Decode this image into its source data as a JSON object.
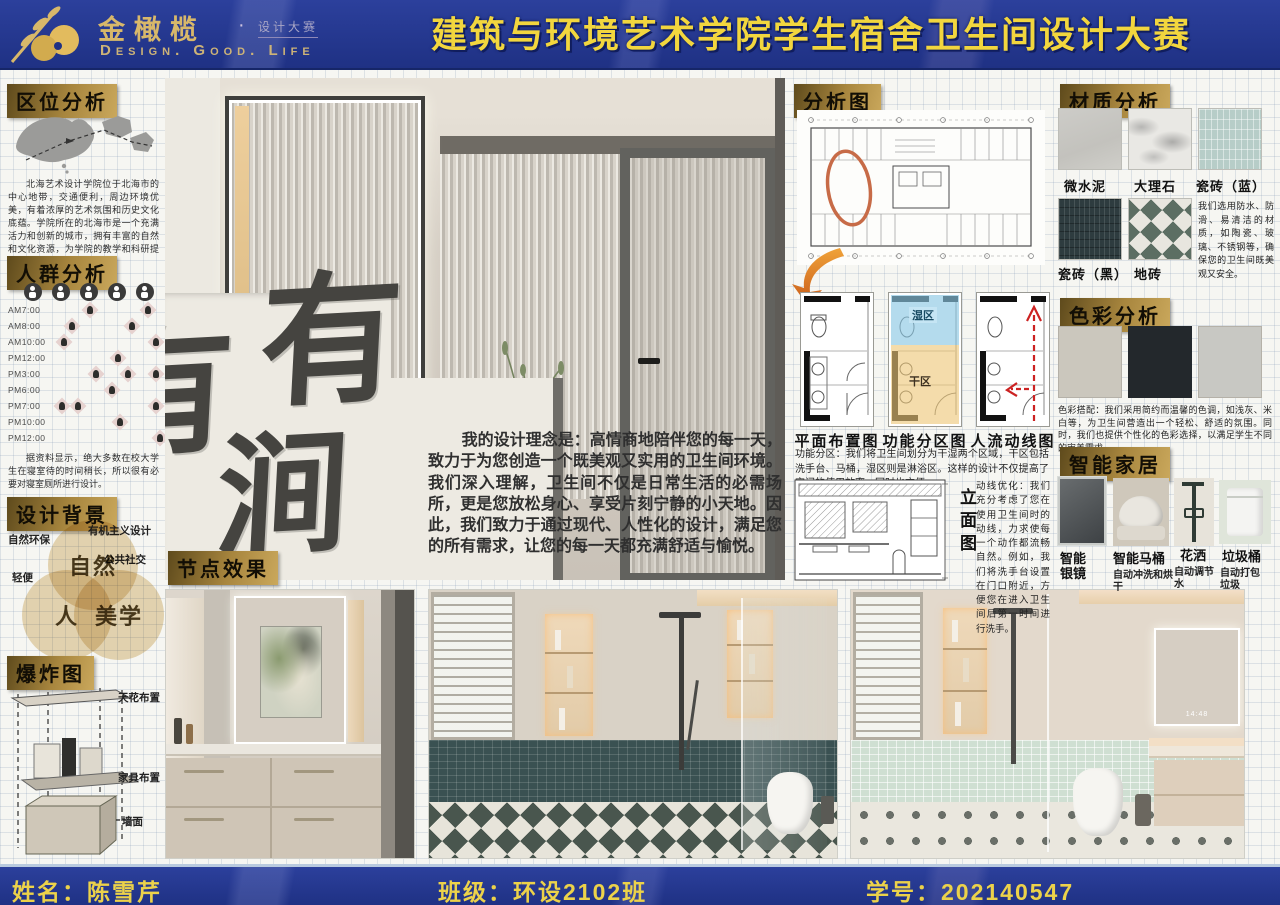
{
  "header": {
    "brand": "金橄榄",
    "brand_dot": "·",
    "brand_sub": "设计大赛",
    "brand_en": "Design. Good. Life",
    "title": "建筑与环境艺术学院学生宿舍卫生间设计大赛",
    "banner_blue": "#24388f",
    "accent_gold": "#f2d63e"
  },
  "footer": {
    "name": "姓名：陈雪芹",
    "class": "班级：环设2102班",
    "student_id": "学号：202140547"
  },
  "hero": {
    "calligraphy": [
      "有",
      "涧"
    ],
    "mirror_time": "14:48"
  },
  "sections": {
    "location": {
      "title": "区位分析",
      "body": "北海艺术设计学院位于北海市的中心地带，交通便利，周边环境优美，有着浓厚的艺术氛围和历史文化底蕴。学院所在的北海市是一个充满活力和创新的城市，拥有丰富的自然和文化资源，为学院的教学和科研提供了得天独厚的条件。"
    },
    "crowd": {
      "title": "人群分析",
      "times": [
        "AM7:00",
        "AM8:00",
        "AM10:00",
        "PM12:00",
        "PM3:00",
        "PM6:00",
        "PM7:00",
        "PM10:00",
        "PM12:00"
      ],
      "body": "据资料显示，绝大多数在校大学生在寝室待的时间稍长，所以很有必要对寝室厕所进行设计。"
    },
    "background": {
      "title": "设计背景",
      "venn": [
        "自然",
        "人",
        "美学"
      ],
      "labels": [
        "自然环保",
        "有机主义设计",
        "轻便",
        "公共社交"
      ]
    },
    "exploded": {
      "title": "爆炸图",
      "labels": [
        "天花布置",
        "家具布置",
        "墙面"
      ]
    },
    "philosophy": "我的设计理念是：高情商地陪伴您的每一天，致力于为您创造一个既美观又实用的卫生间环境。我们深入理解，卫生间不仅是日常生活的必需场所，更是您放松身心、享受片刻宁静的小天地。因此，我们致力于通过现代、人性化的设计，满足您的所有需求，让您的每一天都充满舒适与愉悦。",
    "node_effects": {
      "title": "节点效果"
    },
    "analysis": {
      "title": "分析图",
      "plans": [
        "平面布置图",
        "功能分区图",
        "人流动线图"
      ],
      "wet_zone": "湿区",
      "dry_zone": "干区",
      "zoning_text": "功能分区：我们将卫生间划分为干湿两个区域，干区包括洗手台、马桶，湿区则是淋浴区。这样的设计不仅提高了空间的使用效率，同时也方便",
      "elevation_label": "立面图",
      "flow_text": "动线优化：我们充分考虑了您在使用卫生间时的动线，力求使每一个动作都流畅自然。例如，我们将洗手台设置在门口附近，方便您在进入卫生间后第一时间进行洗手。"
    },
    "materials": {
      "title": "材质分析",
      "items": [
        "微水泥",
        "大理石",
        "瓷砖（蓝）",
        "瓷砖（黑）",
        "地砖"
      ],
      "body": "我们选用防水、防滑、易清洁的材质，如陶瓷、玻璃、不锈钢等，确保您的卫生间既美观又安全。"
    },
    "colors": {
      "title": "色彩分析",
      "swatches": [
        "#cbc7bd",
        "#23282c",
        "#c8c8c3"
      ],
      "body": "色彩搭配：我们采用简约而温馨的色调，如浅灰、米白等，为卫生间营造出一个轻松、舒适的氛围。同时，我们也提供个性化的色彩选择，以满足学生不同的审美需求。"
    },
    "smart": {
      "title": "智能家居",
      "items": [
        {
          "name": "智能银镜",
          "desc": ""
        },
        {
          "name": "智能马桶",
          "desc": "自动冲洗和烘干"
        },
        {
          "name": "花洒",
          "desc": "自动调节水"
        },
        {
          "name": "垃圾桶",
          "desc": "自动打包垃圾"
        }
      ]
    }
  },
  "icons": {
    "logo": "olive-branch-icon",
    "crowd_activities": "person-activity-icon",
    "map": "china-map",
    "analysis_highlight": "orange-ellipse-highlight",
    "analysis_arrow": "orange-flow-arrow-icon",
    "traffic_arrows": "red-dashed-arrow-icon"
  }
}
